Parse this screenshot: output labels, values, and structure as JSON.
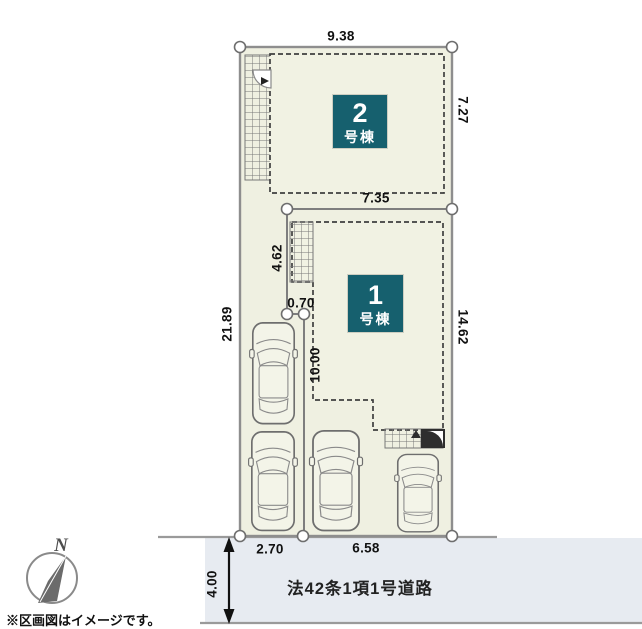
{
  "site_plan": {
    "dimensions": {
      "top_width": "9.38",
      "lot2_right_depth": "7.27",
      "lot1_top_width": "7.35",
      "lot2_left_depth": "4.62",
      "boundary_offset": "0.70",
      "left_total_depth": "21.89",
      "lot1_right_depth": "14.62",
      "driveway_depth": "10.00",
      "frontage_left": "2.70",
      "frontage_right": "6.58",
      "road_width": "4.00"
    },
    "buildings": [
      {
        "number": "2",
        "label": "号棟"
      },
      {
        "number": "1",
        "label": "号棟"
      }
    ],
    "road": {
      "label": "法42条1項1号道路"
    },
    "compass": {
      "north_label": "N"
    },
    "disclaimer": "※区画図はイメージです。",
    "colors": {
      "lot_fill": "#eff0e1",
      "building_fill": "#f1f2e3",
      "building_label_bg": "#16606e",
      "building_label_text": "#ffffff",
      "road_fill": "#e7ebf1",
      "boundary_line": "#8e8e8e",
      "outline_dark": "#3f3f3f"
    }
  }
}
